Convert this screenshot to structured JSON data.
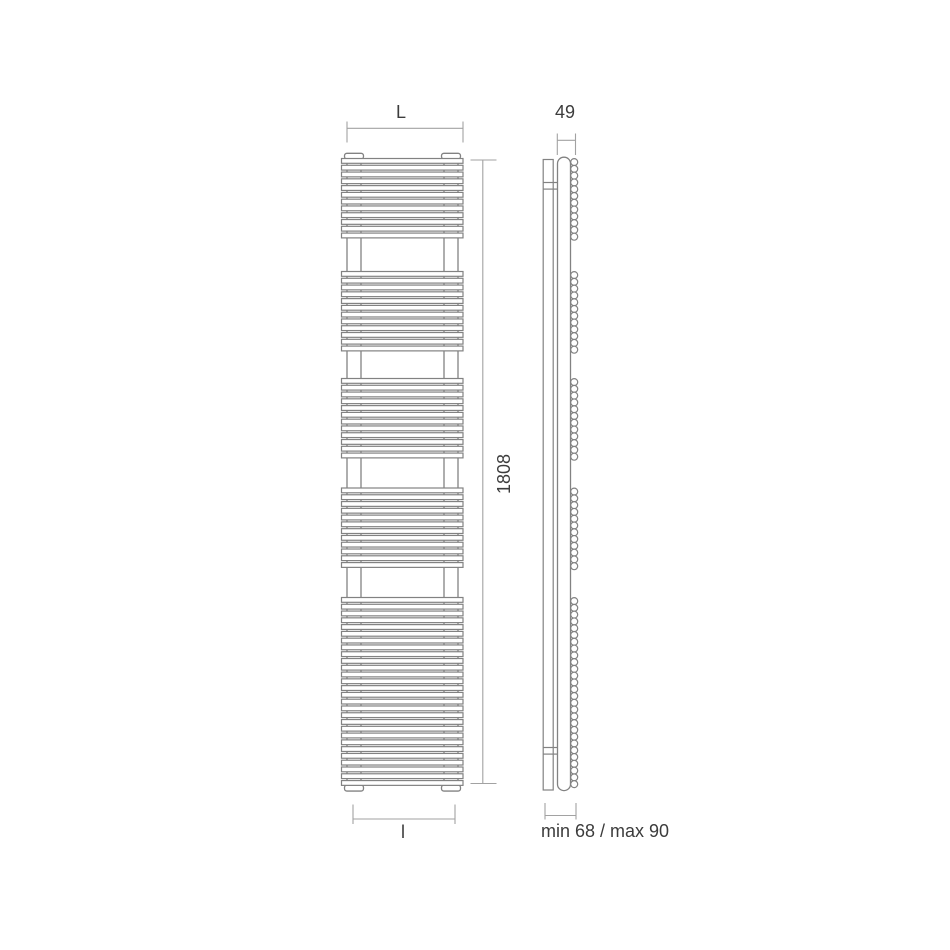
{
  "drawing": {
    "type": "technical-dimension-drawing",
    "subject": "vertical towel-rail radiator, front and side elevation",
    "front_view": {
      "bar_groups": [
        12,
        12,
        12,
        12,
        28
      ]
    },
    "side_view": {
      "circle_groups": [
        12,
        12,
        12,
        12,
        28
      ]
    }
  },
  "labels": {
    "width_top": "L",
    "depth_top": "49",
    "height_right": "1808",
    "width_bottom": "l",
    "wall_distance": "min 68 / max 90"
  },
  "colors": {
    "drawing_line": "#828282",
    "dimension_line": "#a2a2a2",
    "label_text": "#3c3c3c",
    "background": "#ffffff"
  }
}
